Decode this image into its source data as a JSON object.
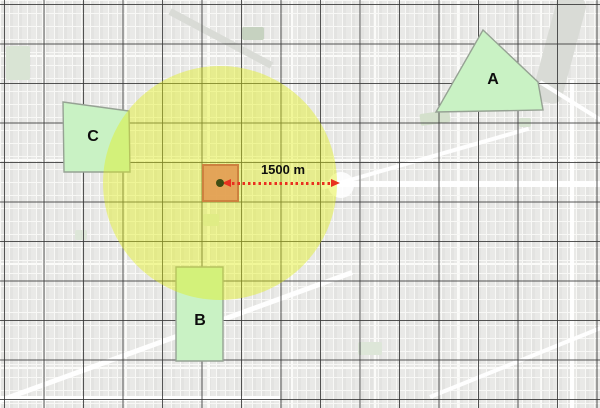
{
  "map": {
    "zones": [
      {
        "id": "A",
        "label": "A"
      },
      {
        "id": "B",
        "label": "B"
      },
      {
        "id": "C",
        "label": "C"
      }
    ],
    "buffer": {
      "distance_label": "1500 m"
    },
    "colors": {
      "basemap_bg": "#e9e9e7",
      "grid_line": "rgba(55,55,55,0.85)",
      "zone_fill": "#c9f2c4",
      "zone_border": "#96a294",
      "buffer_fill": "rgba(226,240,20,0.42)",
      "site_fill": "rgba(227,160,85,0.95)",
      "site_border": "rgba(203,127,62,0.95)",
      "arrow_red": "#e8301f",
      "dot_color": "#3f4d13",
      "label_color": "#0d0d0d"
    }
  }
}
